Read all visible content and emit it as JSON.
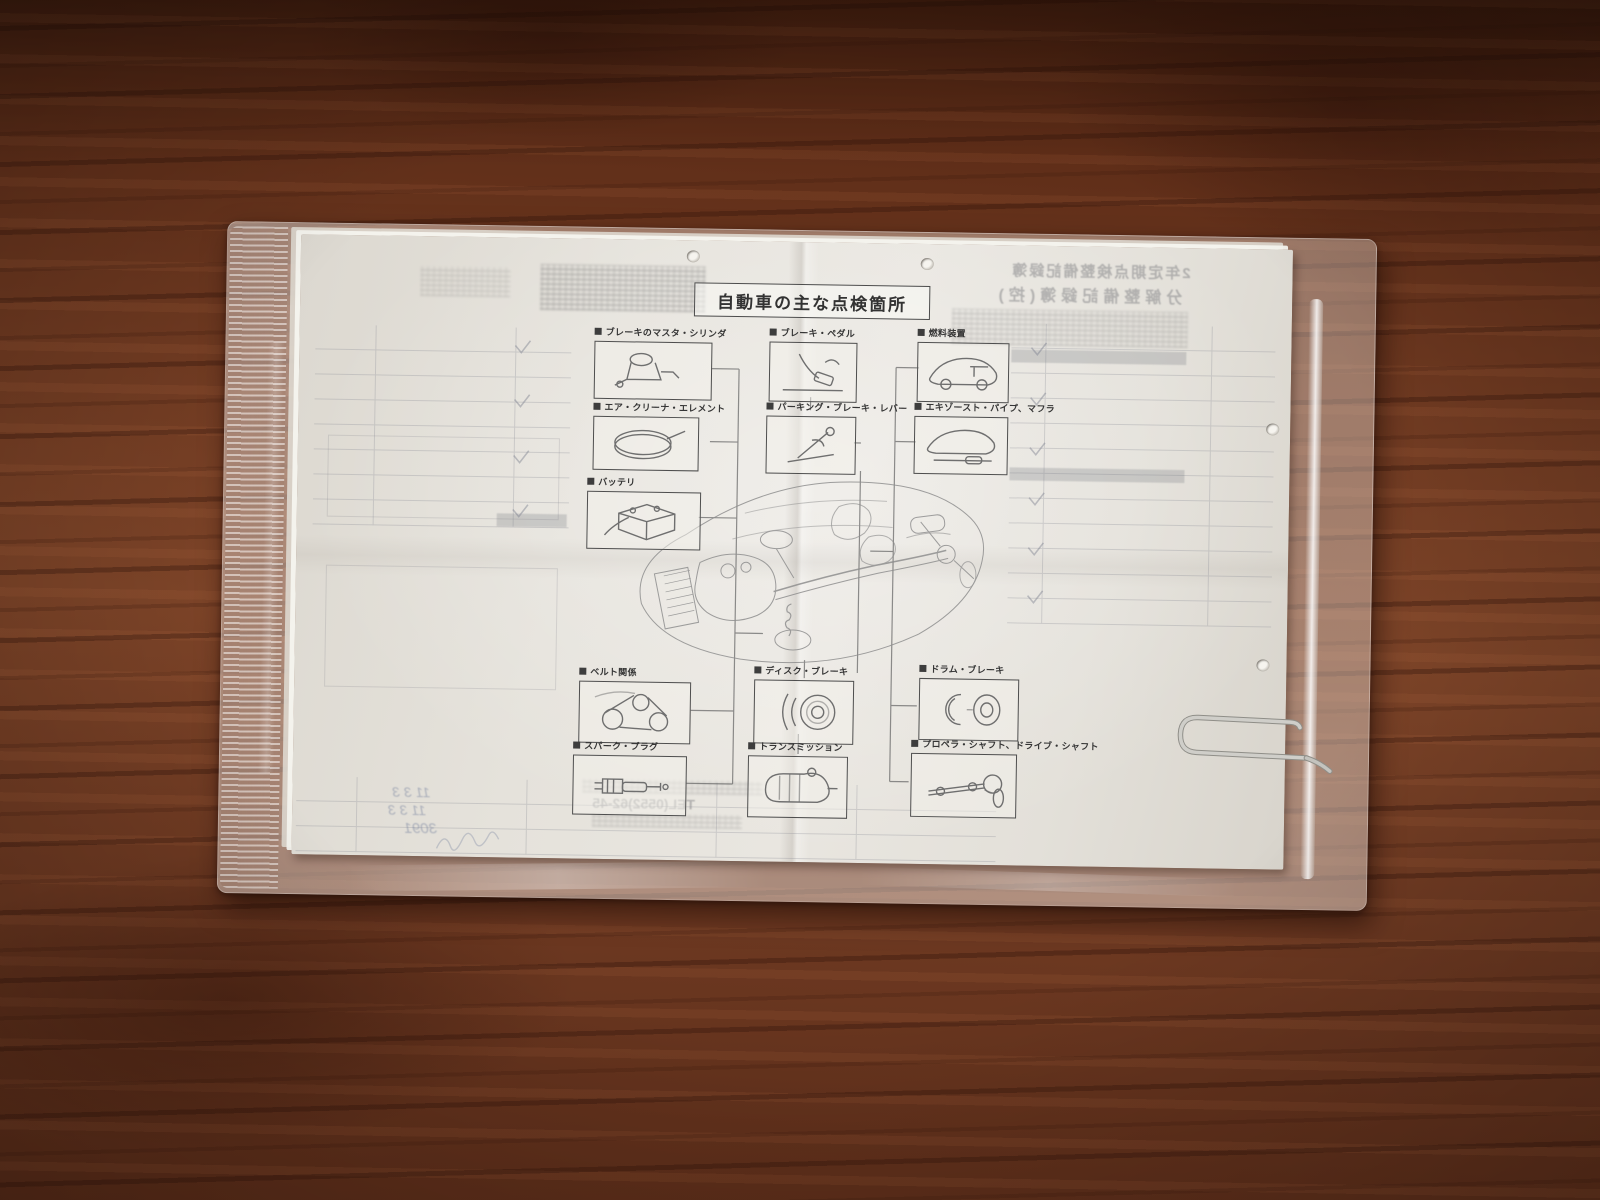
{
  "document": {
    "title": "自動車の主な点検箇所",
    "inspection_points": [
      {
        "label": "ブレーキのマスタ・シリンダ"
      },
      {
        "label": "ブレーキ・ペダル"
      },
      {
        "label": "燃料装置"
      },
      {
        "label": "エア・クリーナ・エレメント"
      },
      {
        "label": "パーキング・ブレーキ・レバー"
      },
      {
        "label": "エキゾースト・パイプ、マフラ"
      },
      {
        "label": "バッテリ"
      },
      {
        "label": "ベルト関係"
      },
      {
        "label": "ディスク・ブレーキ"
      },
      {
        "label": "ドラム・ブレーキ"
      },
      {
        "label": "スパーク・プラグ"
      },
      {
        "label": "トランスミッション"
      },
      {
        "label": "プロペラ・シャフト、ドライブ・シャフト"
      }
    ]
  },
  "bleedthrough": {
    "record_book_line1": "2年定期点検整備記録簿",
    "record_book_line2": "分解整備記録簿(控)",
    "tel_line": "TEL(0552)62-45",
    "stamp_number": "3091",
    "handwritten_date1": "11 3 3",
    "handwritten_date2": "11 3 3"
  },
  "colors": {
    "wood": "#6e3a24",
    "paper": "#e5e2db",
    "ink": "#3d3d3d"
  }
}
